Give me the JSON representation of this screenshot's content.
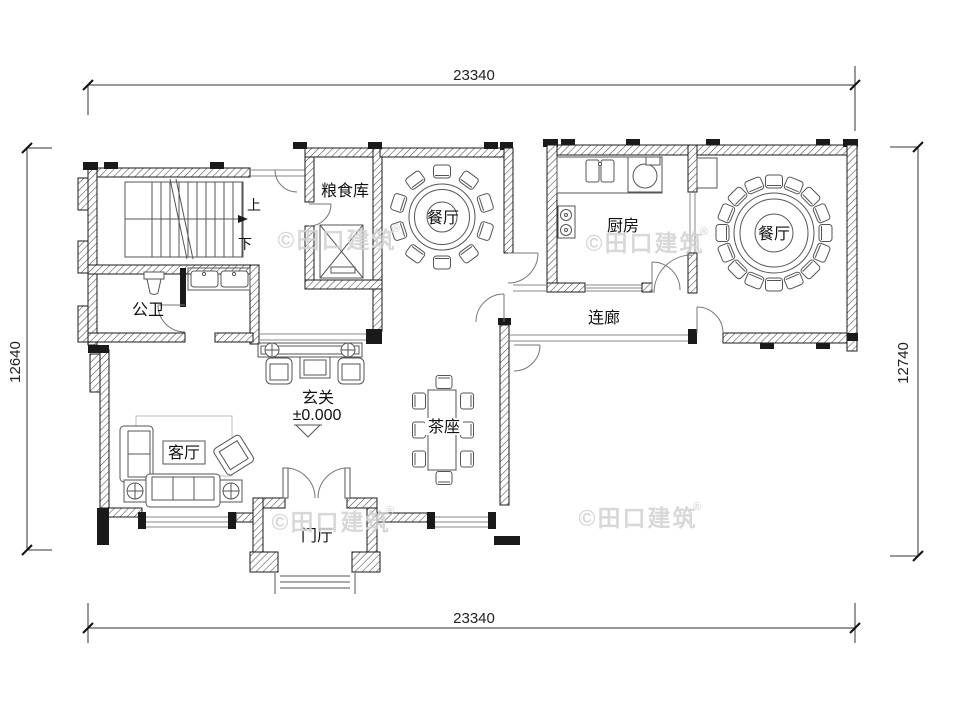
{
  "drawing": {
    "type": "floor-plan",
    "background": "#ffffff",
    "line_color": "#1a1a1a",
    "watermark_color": "#d2d2d2"
  },
  "dimensions": {
    "top": "23340",
    "bottom": "23340",
    "left": "12640",
    "right": "12740"
  },
  "labels": {
    "grain_storage": "粮食库",
    "dining_left": "餐厅",
    "dining_right": "餐厅",
    "kitchen": "厨房",
    "bathroom": "公卫",
    "corridor": "连廊",
    "entry_hall": "玄关",
    "entry_level": "±0.000",
    "living_room": "客厅",
    "tea_seat": "茶座",
    "foyer": "门厅",
    "stairs_up": "上",
    "stairs_down": "下"
  },
  "watermark": {
    "text": "©田口建筑",
    "reg": "®"
  }
}
